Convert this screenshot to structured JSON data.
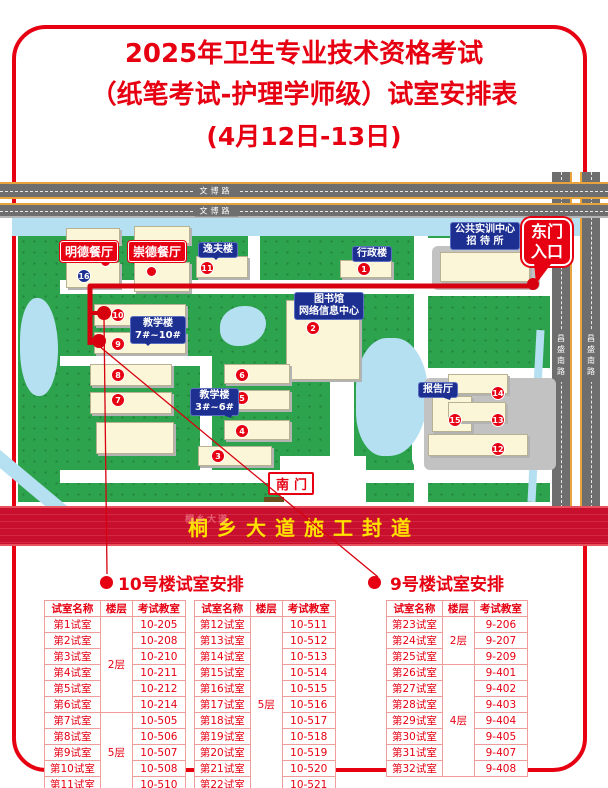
{
  "title": {
    "line1": "2025年卫生专业技术资格考试",
    "line2": "（纸笔考试-护理学师级）试室安排表",
    "line3": "(4月12日-13日)"
  },
  "colors": {
    "accent_red": "#e60012",
    "banner_bg": "#c8102e",
    "banner_text": "#ffe100",
    "label_blue": "#1d3091",
    "road_gray": "#6e6e6e",
    "lawn_green": "#2ea34d",
    "water_blue": "#b5e0f2",
    "building_cream": "#fbf6d8"
  },
  "map": {
    "top_road_label": "文博路",
    "right_road_label": "昌盛南路",
    "banner_text": "桐乡大道施工封道",
    "banner_watermark": "桐乡大道",
    "east_gate": {
      "line1": "东门",
      "line2": "入口"
    },
    "south_gate": "南门",
    "labels": {
      "mingde": "明德餐厅",
      "chongde": "崇德餐厅",
      "yifu": "逸夫楼",
      "xingzheng": "行政楼",
      "shixun_line1": "公共实训中心",
      "shixun_line2": "招 待 所",
      "library_line1": "图书馆",
      "library_line2": "网络信息中心",
      "teach710_line1": "教学楼",
      "teach710_line2": "7#~10#",
      "teach36_line1": "教学楼",
      "teach36_line2": "3#~6#",
      "report_hall": "报告厅"
    },
    "pins": [
      {
        "num": "1",
        "x": 364,
        "y": 101,
        "color": "red"
      },
      {
        "num": "2",
        "x": 313,
        "y": 160,
        "color": "red"
      },
      {
        "num": "3",
        "x": 218,
        "y": 288,
        "color": "red"
      },
      {
        "num": "4",
        "x": 242,
        "y": 263,
        "color": "red"
      },
      {
        "num": "5",
        "x": 242,
        "y": 230,
        "color": "red"
      },
      {
        "num": "6",
        "x": 242,
        "y": 207,
        "color": "red"
      },
      {
        "num": "7",
        "x": 118,
        "y": 232,
        "color": "red"
      },
      {
        "num": "8",
        "x": 118,
        "y": 207,
        "color": "red"
      },
      {
        "num": "9",
        "x": 118,
        "y": 176,
        "color": "red"
      },
      {
        "num": "10",
        "x": 118,
        "y": 147,
        "color": "red"
      },
      {
        "num": "11",
        "x": 207,
        "y": 100,
        "color": "red"
      },
      {
        "num": "12",
        "x": 498,
        "y": 281,
        "color": "red"
      },
      {
        "num": "13",
        "x": 498,
        "y": 252,
        "color": "red"
      },
      {
        "num": "14",
        "x": 498,
        "y": 225,
        "color": "red"
      },
      {
        "num": "15",
        "x": 455,
        "y": 252,
        "color": "red"
      },
      {
        "num": "16",
        "x": 84,
        "y": 108,
        "color": "blue"
      }
    ]
  },
  "sections": [
    {
      "title": "10号楼试室安排",
      "tables": [
        {
          "headers": [
            "试室名称",
            "楼层",
            "考试教室"
          ],
          "rows": [
            {
              "name": "第1试室",
              "floor": "2层",
              "span": 6,
              "room": "10-205"
            },
            {
              "name": "第2试室",
              "room": "10-208"
            },
            {
              "name": "第3试室",
              "room": "10-210"
            },
            {
              "name": "第4试室",
              "room": "10-211"
            },
            {
              "name": "第5试室",
              "room": "10-212"
            },
            {
              "name": "第6试室",
              "room": "10-214"
            },
            {
              "name": "第7试室",
              "floor": "5层",
              "span": 5,
              "room": "10-505"
            },
            {
              "name": "第8试室",
              "room": "10-506"
            },
            {
              "name": "第9试室",
              "room": "10-507"
            },
            {
              "name": "第10试室",
              "room": "10-508"
            },
            {
              "name": "第11试室",
              "room": "10-510"
            }
          ]
        },
        {
          "headers": [
            "试室名称",
            "楼层",
            "考试教室"
          ],
          "rows": [
            {
              "name": "第12试室",
              "floor": "5层",
              "span": 11,
              "room": "10-511"
            },
            {
              "name": "第13试室",
              "room": "10-512"
            },
            {
              "name": "第14试室",
              "room": "10-513"
            },
            {
              "name": "第15试室",
              "room": "10-514"
            },
            {
              "name": "第16试室",
              "room": "10-515"
            },
            {
              "name": "第17试室",
              "room": "10-516"
            },
            {
              "name": "第18试室",
              "room": "10-517"
            },
            {
              "name": "第19试室",
              "room": "10-518"
            },
            {
              "name": "第20试室",
              "room": "10-519"
            },
            {
              "name": "第21试室",
              "room": "10-520"
            },
            {
              "name": "第22试室",
              "room": "10-521"
            }
          ]
        }
      ]
    },
    {
      "title": "9号楼试室安排",
      "tables": [
        {
          "headers": [
            "试室名称",
            "楼层",
            "考试教室"
          ],
          "rows": [
            {
              "name": "第23试室",
              "floor": "2层",
              "span": 3,
              "room": "9-206"
            },
            {
              "name": "第24试室",
              "room": "9-207"
            },
            {
              "name": "第25试室",
              "room": "9-209"
            },
            {
              "name": "第26试室",
              "floor": "4层",
              "span": 7,
              "room": "9-401"
            },
            {
              "name": "第27试室",
              "room": "9-402"
            },
            {
              "name": "第28试室",
              "room": "9-403"
            },
            {
              "name": "第29试室",
              "room": "9-404"
            },
            {
              "name": "第30试室",
              "room": "9-405"
            },
            {
              "name": "第31试室",
              "room": "9-407"
            },
            {
              "name": "第32试室",
              "room": "9-408"
            }
          ]
        }
      ]
    }
  ]
}
